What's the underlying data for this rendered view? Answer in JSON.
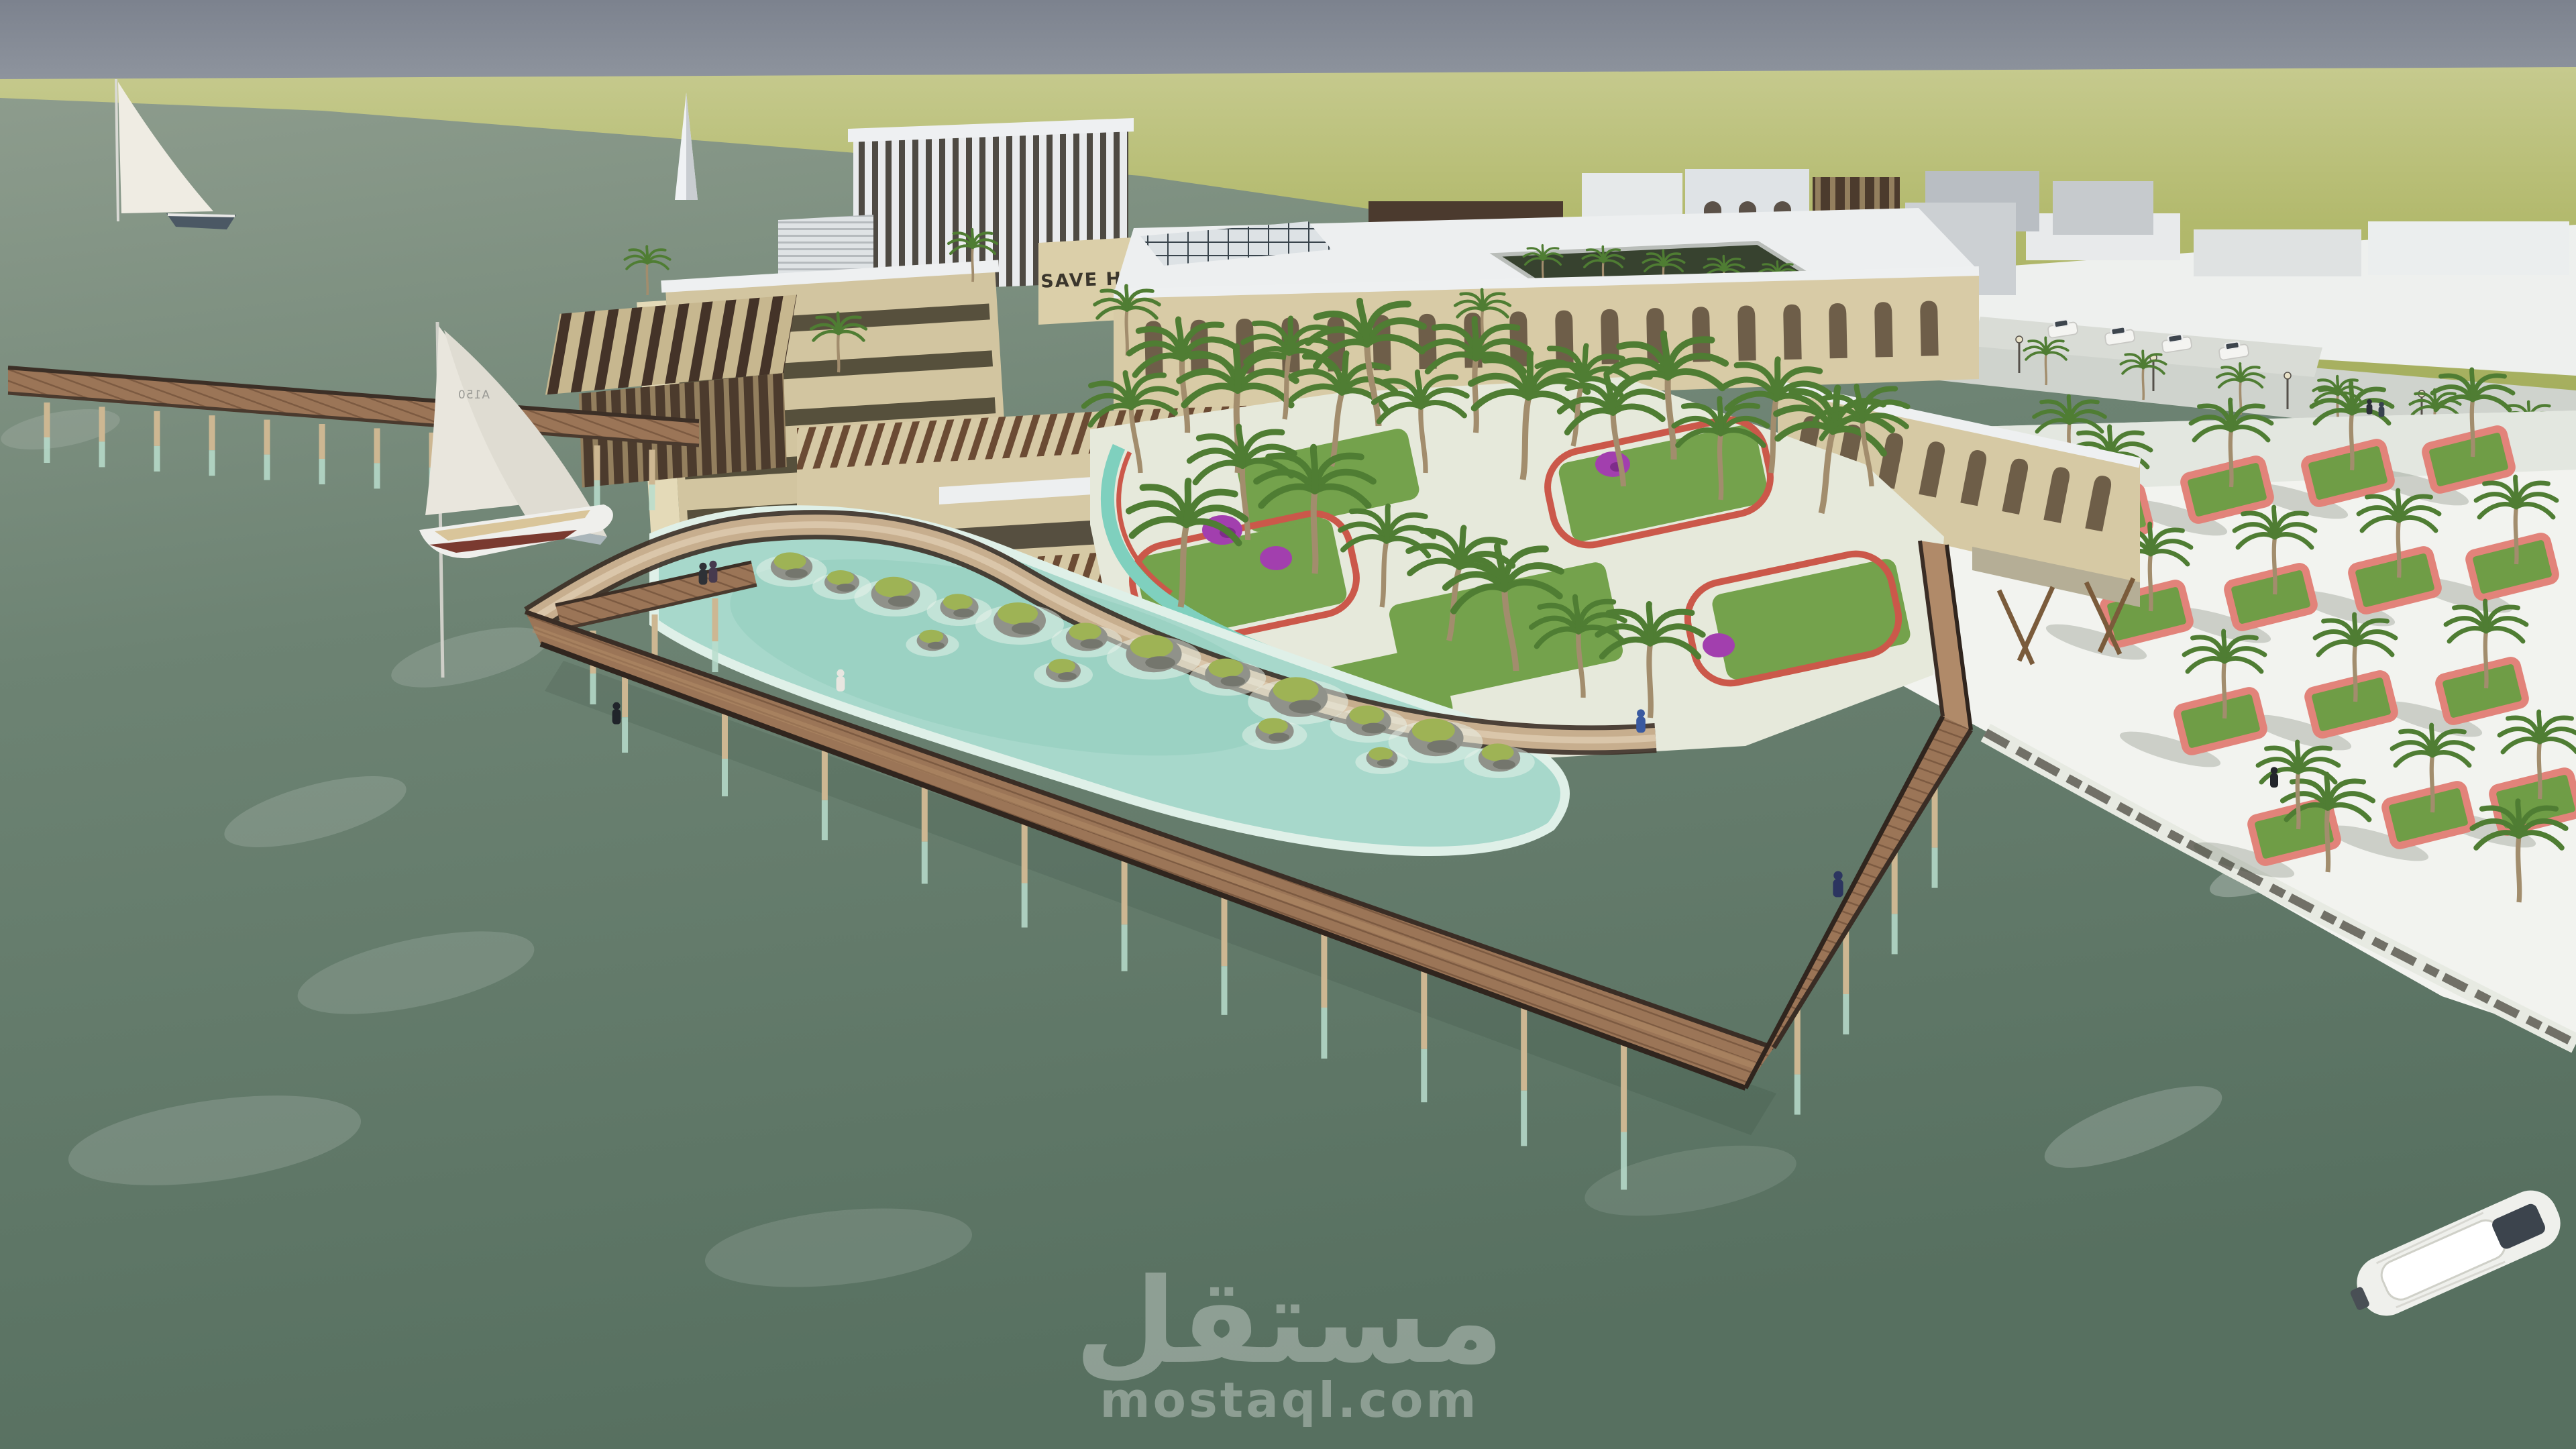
{
  "scene": {
    "type": "architectural-3d-render",
    "title": "Waterfront heritage complex - aerial visualization",
    "sign_text": "SAVE HERITAGE",
    "sail_number": "A150"
  },
  "watermark": {
    "brand_arabic": "مستقل",
    "brand_domain": "mostaql.com"
  },
  "colors": {
    "sky": "#858b97",
    "distant_land": "#aeb566",
    "sea": "#6d8375",
    "lagoon": "#a7d8cb",
    "pavement": "#f1f2ee",
    "boardwalk_wood": "#9b7557",
    "railing": "#43352c",
    "brick": "#d4c7a2",
    "pergola_brown": "#6b4b34",
    "roof_white": "#edeff0",
    "lawn": "#74a24c",
    "flower_red": "#cb584a",
    "flower_pink": "#e2837a",
    "bougainvillea": "#a23fae",
    "sail_white": "#eae7dd",
    "hull_red": "#7a3a30"
  }
}
